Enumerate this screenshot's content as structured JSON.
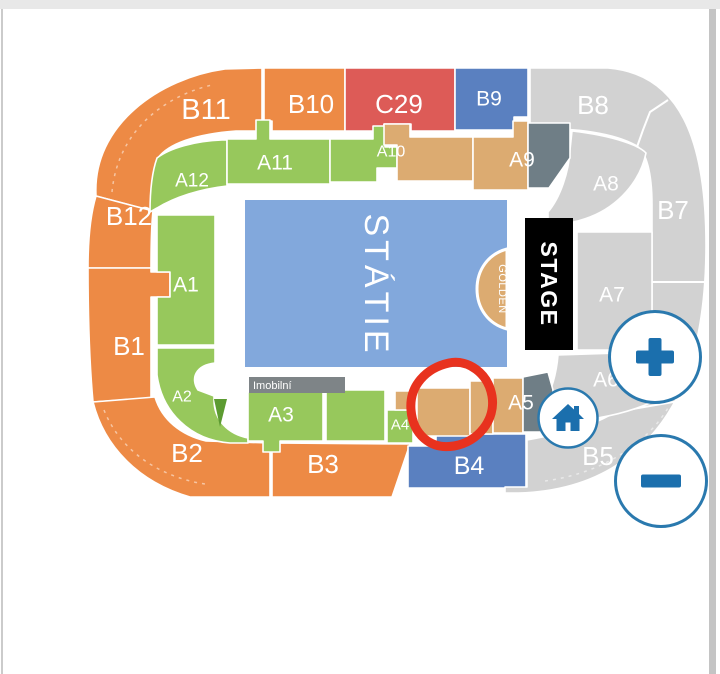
{
  "colors": {
    "orange": "#ED8A45",
    "green": "#97C85C",
    "dark_green": "#5C9B31",
    "red": "#DD5B57",
    "blue": "#5A80C0",
    "light_blue": "#82A8DC",
    "gray": "#D2D2D2",
    "tan": "#DCAB71",
    "slate": "#6F7E86",
    "bar_gray": "#7E8487",
    "black": "#000000",
    "white": "#FFFFFF",
    "control_blue": "#1B6FAD",
    "control_border": "#2A79AE",
    "annotation_red": "#E8321E"
  },
  "sections": {
    "b11": "B11",
    "b10": "B10",
    "c29": "C29",
    "b9": "B9",
    "b8": "B8",
    "a12": "A12",
    "a11": "A11",
    "a10": "A10",
    "a9": "A9",
    "a8": "A8",
    "b12": "B12",
    "b7": "B7",
    "a1": "A1",
    "a7": "A7",
    "b1": "B1",
    "a2": "A2",
    "a6": "A6",
    "b2": "B2",
    "a3": "A3",
    "a4": "A4",
    "a5": "A5",
    "b3": "B3",
    "b4": "B4",
    "b5": "B5"
  },
  "center": {
    "standing_label": "STÁTIE",
    "golden_label": "GOLDEN",
    "stage_label": "STAGE",
    "accessible_label": "Imobilní"
  },
  "controls": {
    "zoom_in_icon": "plus-icon",
    "zoom_out_icon": "minus-icon",
    "home_icon": "home-icon"
  },
  "annotation": {
    "type": "hand-drawn-circle",
    "color": "#E8321E",
    "marks": "tan section between A4 and A5"
  }
}
